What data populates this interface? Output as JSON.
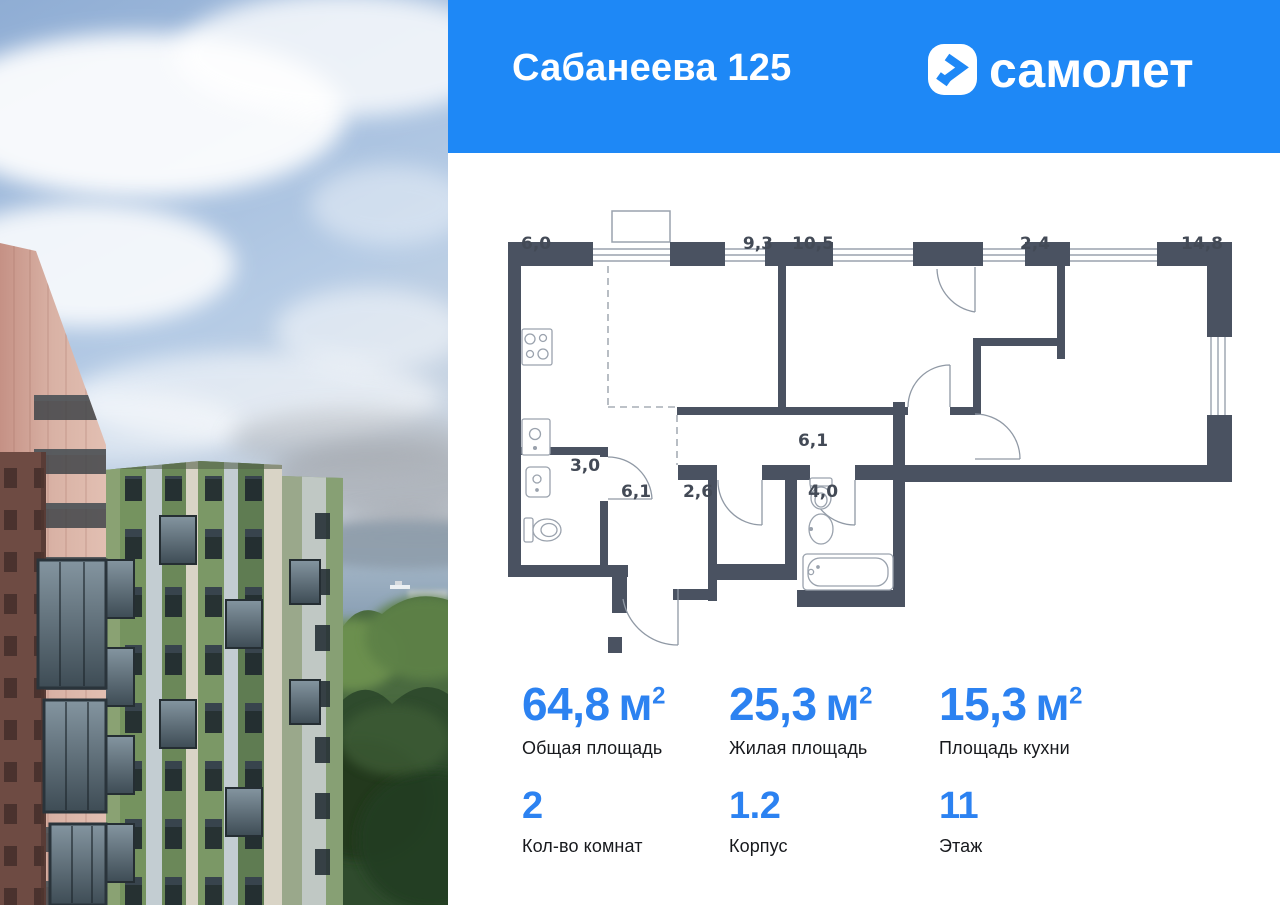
{
  "header": {
    "title": "Сабанеева 125",
    "brand": "самолет",
    "logo_icon": "samolet-arrow-icon"
  },
  "floor_plan": {
    "areas": {
      "kitchen": "6,0",
      "living": "9,3",
      "bedroom": "10,5",
      "wardrobe": "2,4",
      "master_bedroom": "14,8",
      "bathroom": "3,0",
      "hallway": "6,1",
      "storage": "2,6",
      "bathroom2": "4,0",
      "corridor": "6,1"
    }
  },
  "stats": {
    "unit_base": "м",
    "unit_sup": "2",
    "row1": [
      {
        "value": "64,8",
        "label": "Общая площадь"
      },
      {
        "value": "25,3",
        "label": "Жилая площадь"
      },
      {
        "value": "15,3",
        "label": "Площадь кухни"
      }
    ],
    "row2": [
      {
        "value": "2",
        "label": "Кол-во комнат"
      },
      {
        "value": "1.2",
        "label": "Корпус"
      },
      {
        "value": "11",
        "label": "Этаж"
      }
    ]
  },
  "colors": {
    "header_blue": "#1E88F6",
    "accent_blue": "#2C82F1",
    "wall_color": "#4A5261"
  }
}
